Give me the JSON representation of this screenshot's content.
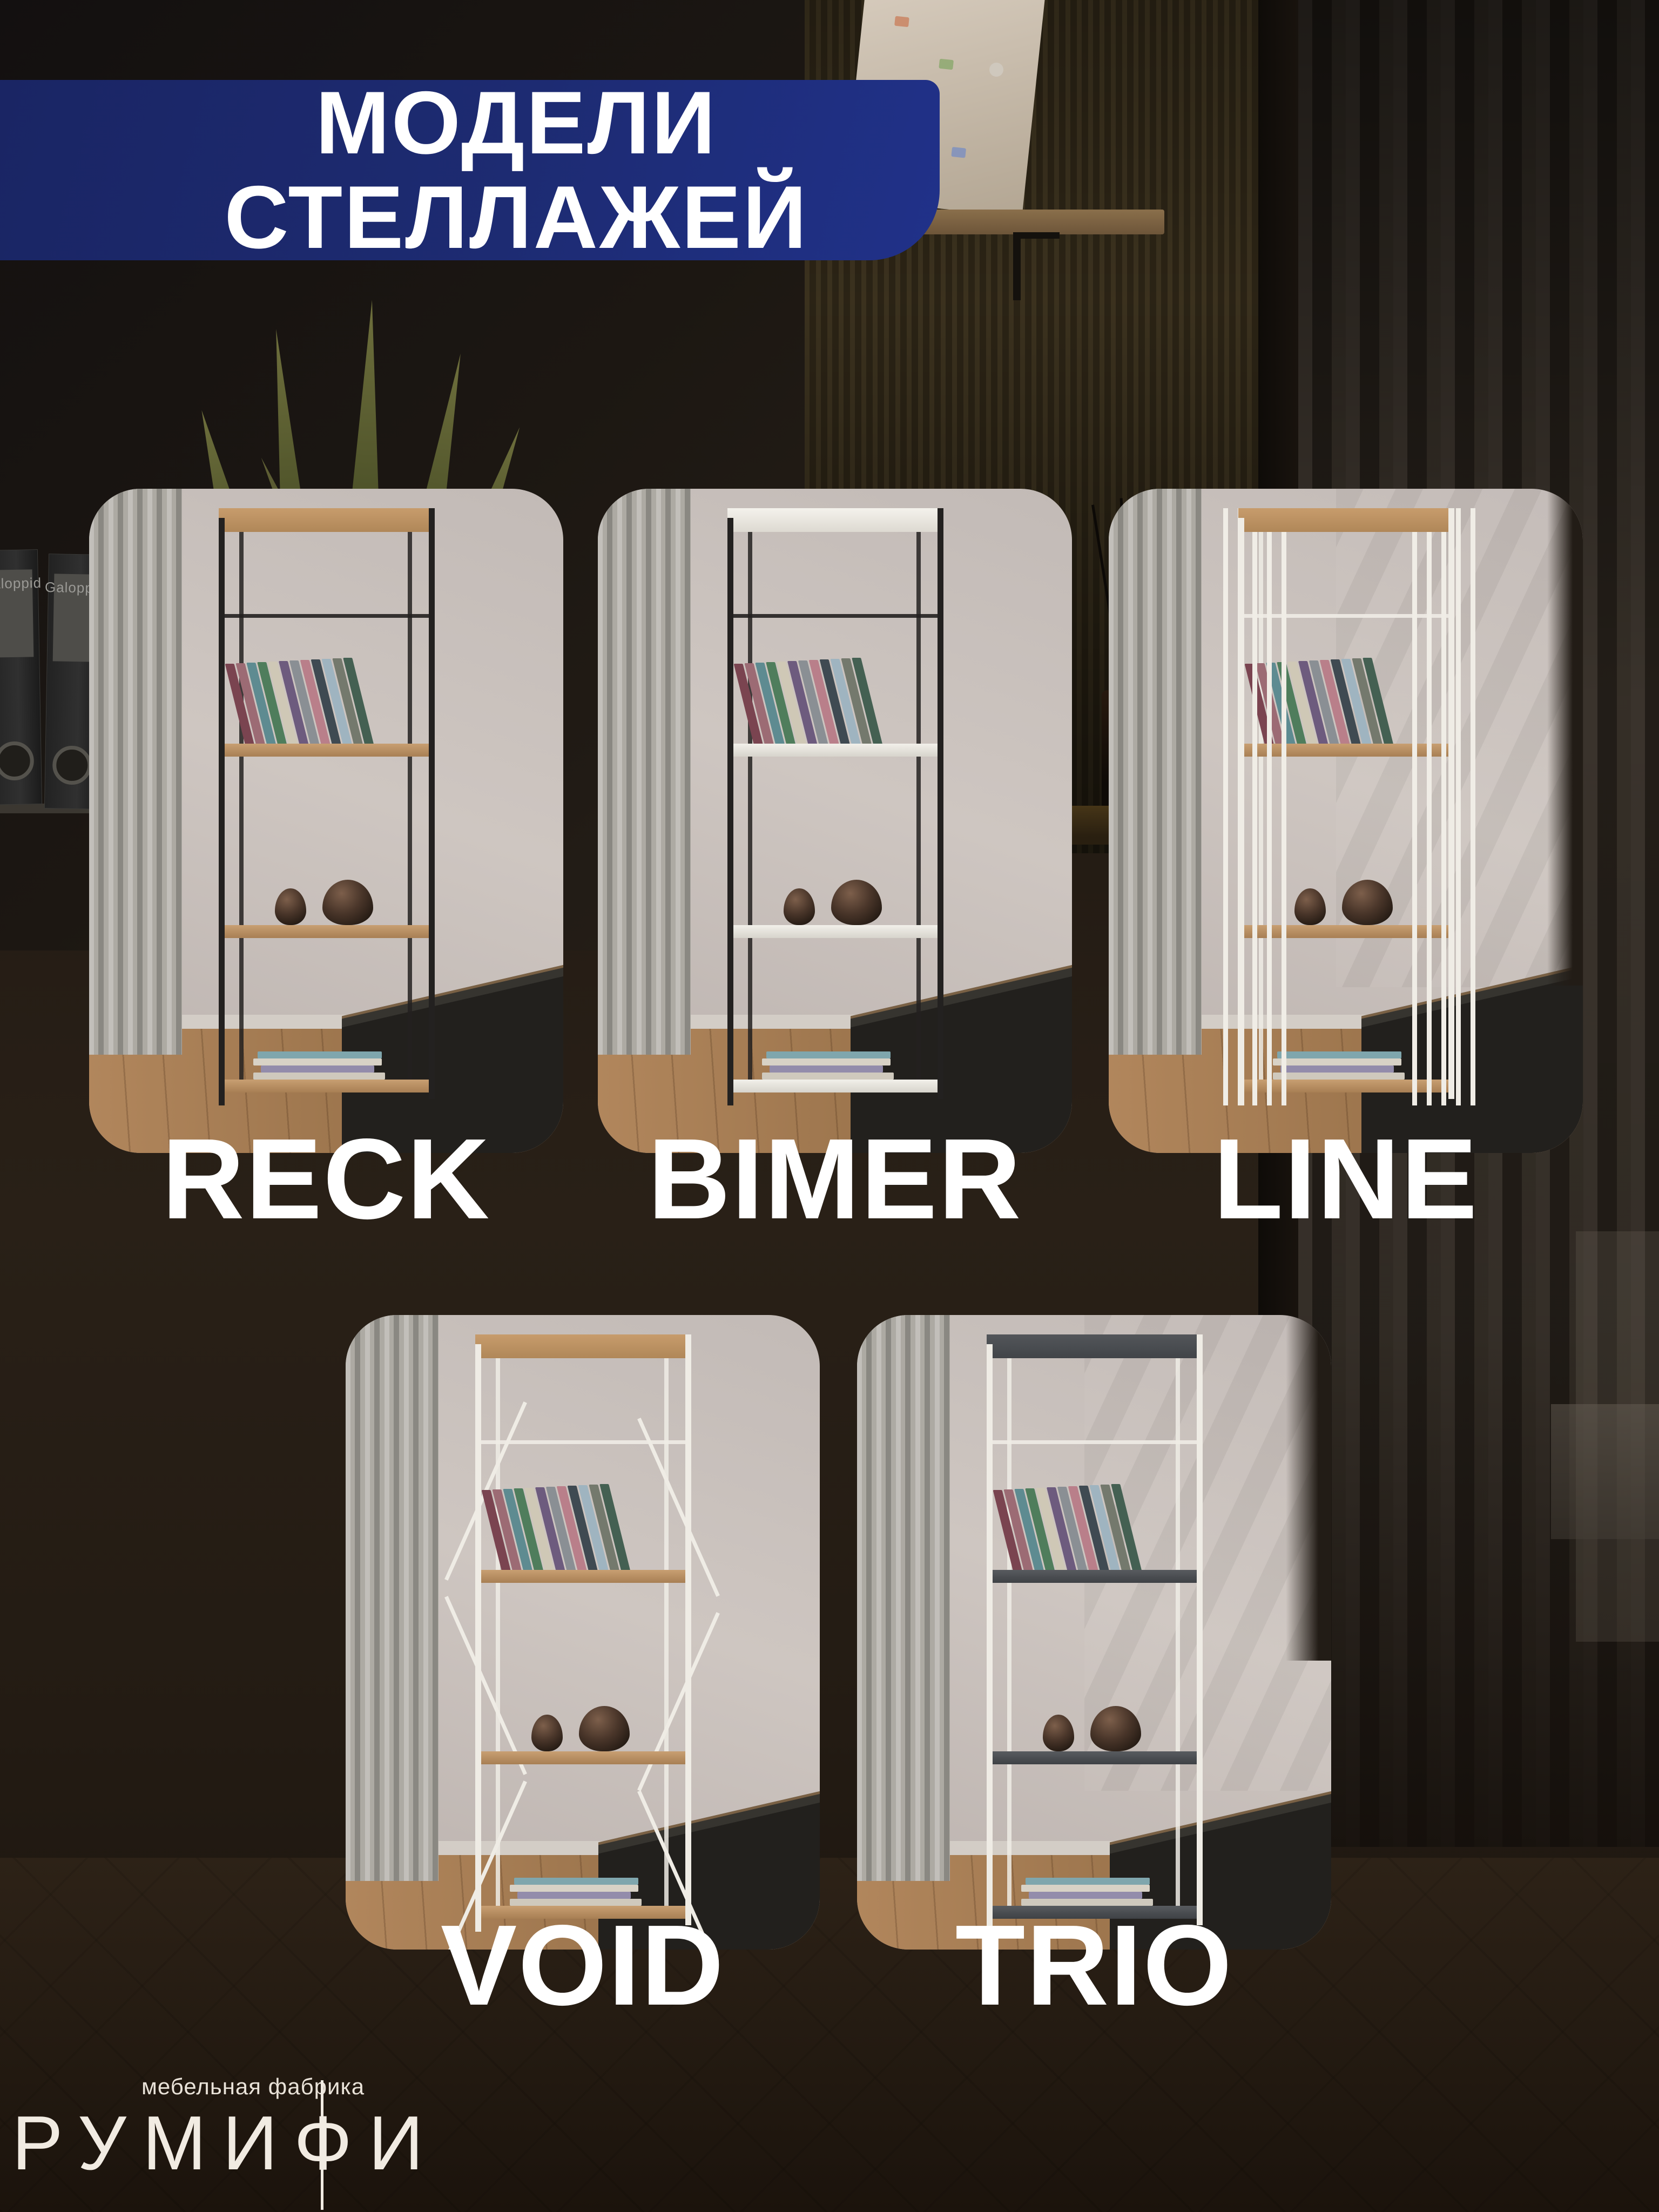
{
  "header": {
    "title_line1": "МОДЕЛИ",
    "title_line2": "СТЕЛЛАЖЕЙ"
  },
  "cards": [
    {
      "label": "RECK",
      "frame": "black",
      "shelves": "wood"
    },
    {
      "label": "BIMER",
      "frame": "black",
      "shelves": "white"
    },
    {
      "label": "LINE",
      "frame": "white-slats",
      "shelves": "wood"
    },
    {
      "label": "VOID",
      "frame": "white-cross",
      "shelves": "wood"
    },
    {
      "label": "TRIO",
      "frame": "white",
      "shelves": "dark"
    }
  ],
  "logo": {
    "tagline": "мебельная фабрика",
    "brand": "РУМИФИ"
  },
  "background": {
    "binder_label": "Galoppid"
  },
  "colors": {
    "banner_blue": "#1d2b72",
    "label_white": "#ffffff",
    "frame_black": "#232120",
    "frame_white": "#efece5",
    "shelf_wood": "#b98f63",
    "shelf_white": "#e9e7df",
    "shelf_dark": "#4b4e52"
  },
  "book_colors": [
    "#7a4450",
    "#9c6b74",
    "#5e8b91",
    "#4f7d5c",
    "#cfc8b6",
    "#6d5b7e",
    "#8a8f94",
    "#b97f8a",
    "#3f4a52",
    "#9fb4c0",
    "#74796d",
    "#446052"
  ]
}
